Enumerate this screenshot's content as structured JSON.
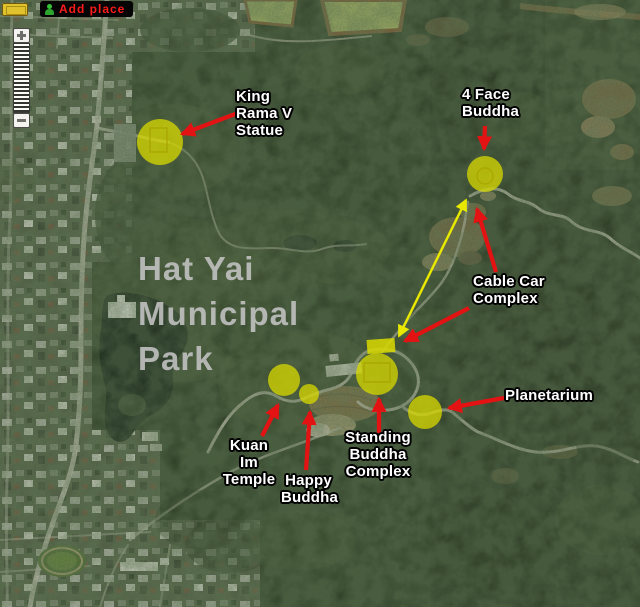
{
  "toolbar": {
    "add_place_label": "Add place"
  },
  "map": {
    "park_title": "Hat Yai\nMunicipal\nPark"
  },
  "annotations": {
    "king_rama_v": {
      "label": "King\nRama V\nStatue",
      "marker": {
        "cx": 160,
        "cy": 142,
        "r": 23
      }
    },
    "four_face_buddha": {
      "label": "4 Face\nBuddha",
      "marker": {
        "cx": 485,
        "cy": 174,
        "r": 18
      }
    },
    "cable_car_complex": {
      "label": "Cable Car\nComplex",
      "arrow_targets": [
        {
          "x": 476,
          "y": 207
        },
        {
          "x": 403,
          "y": 342
        }
      ]
    },
    "cable_car_station_rect": {
      "x": 367,
      "y": 339,
      "w": 28,
      "h": 14
    },
    "cable_car_link": {
      "from": {
        "x": 399,
        "y": 336
      },
      "to": {
        "x": 466,
        "y": 200
      }
    },
    "planetarium": {
      "label": "Planetarium",
      "marker": {
        "cx": 425,
        "cy": 412,
        "r": 17
      }
    },
    "kuan_im_temple": {
      "label": "Kuan Im\nTemple",
      "marker": {
        "cx": 284,
        "cy": 380,
        "r": 16
      }
    },
    "happy_buddha": {
      "label": "Happy\nBuddha",
      "marker": {
        "cx": 309,
        "cy": 394,
        "r": 10
      }
    },
    "standing_buddha_complex": {
      "label": "Standing\nBuddha\nComplex",
      "marker": {
        "cx": 377,
        "cy": 374,
        "r": 21
      }
    }
  },
  "colors": {
    "highlight_yellow": "#d9d900",
    "arrow_red": "#e41313",
    "arrow_yellow": "#e8e800",
    "label_text": "#ffffff",
    "park_title_text": "#c4c4c4",
    "add_place_text": "#ff1a1a"
  }
}
